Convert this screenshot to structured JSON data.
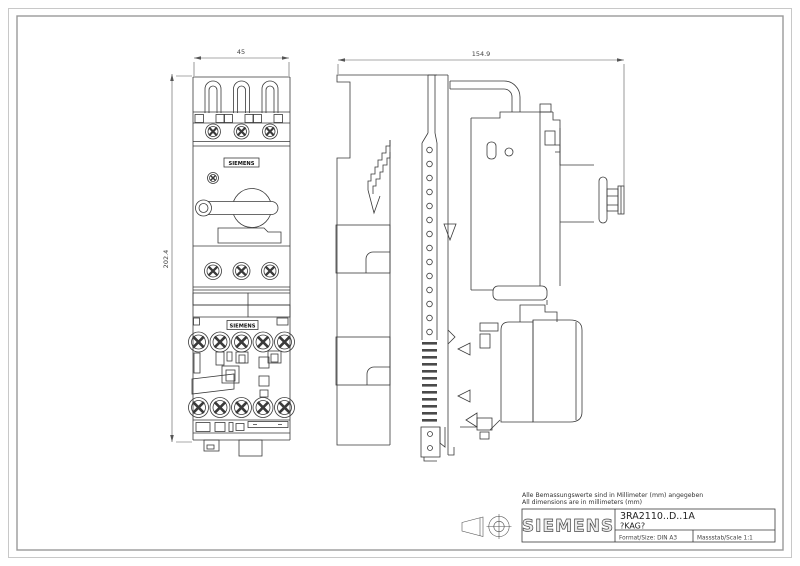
{
  "drawing": {
    "notes": {
      "line1_de": "Alle Bemassungswerte sind in Millimeter (mm) angegeben",
      "line2_en": "All dimensions are in millimeters (mm)"
    },
    "dimensions": {
      "front_width": "45",
      "overall_depth": "154.9",
      "overall_height": "202.4"
    },
    "device_labels": {
      "upper": "SIEMENS",
      "lower": "SIEMENS"
    },
    "title_block": {
      "manufacturer": "SIEMENS",
      "product_number": "3RA2110..D..1A",
      "variant_code": "?KAG?",
      "format": "Format/Size: DIN A3",
      "scale": "Massstab/Scale 1:1"
    },
    "colors": {
      "background": "#ffffff",
      "line": "#3a3a3a",
      "dimension": "#555555",
      "border_outer": "#c8c8c8",
      "border_inner": "#999999"
    }
  }
}
